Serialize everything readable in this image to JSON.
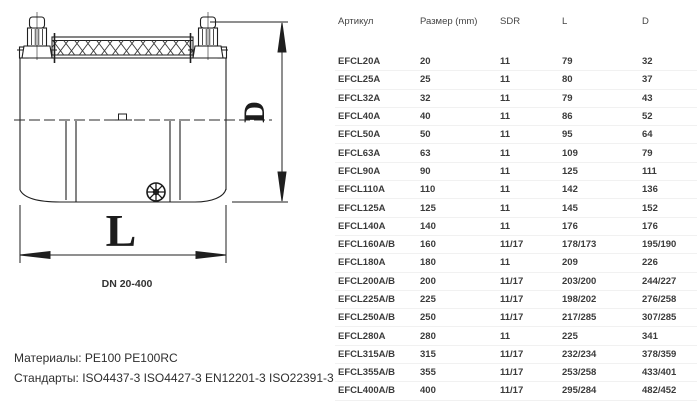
{
  "diagram": {
    "dimension_labels": {
      "diameter": "D",
      "length": "L"
    },
    "caption": "DN 20-400",
    "icons": {
      "center_symbol": "mold-date-wheel-icon"
    }
  },
  "notes": {
    "materials": "Материалы: PE100 PE100RC",
    "standards": "Стандарты: ISO4437-3 ISO4427-3 EN12201-3 ISO22391-3"
  },
  "table": {
    "headers": [
      "Артикул",
      "Размер (mm)",
      "SDR",
      "L",
      "D"
    ],
    "rows": [
      [
        "EFCL20A",
        "20",
        "11",
        "79",
        "32"
      ],
      [
        "EFCL25A",
        "25",
        "11",
        "80",
        "37"
      ],
      [
        "EFCL32A",
        "32",
        "11",
        "79",
        "43"
      ],
      [
        "EFCL40A",
        "40",
        "11",
        "86",
        "52"
      ],
      [
        "EFCL50A",
        "50",
        "11",
        "95",
        "64"
      ],
      [
        "EFCL63A",
        "63",
        "11",
        "109",
        "79"
      ],
      [
        "EFCL90A",
        "90",
        "11",
        "125",
        "111"
      ],
      [
        "EFCL110A",
        "110",
        "11",
        "142",
        "136"
      ],
      [
        "EFCL125A",
        "125",
        "11",
        "145",
        "152"
      ],
      [
        "EFCL140A",
        "140",
        "11",
        "176",
        "176"
      ],
      [
        "EFCL160A/B",
        "160",
        "11/17",
        "178/173",
        "195/190"
      ],
      [
        "EFCL180A",
        "180",
        "11",
        "209",
        "226"
      ],
      [
        "EFCL200A/B",
        "200",
        "11/17",
        "203/200",
        "244/227"
      ],
      [
        "EFCL225A/B",
        "225",
        "11/17",
        "198/202",
        "276/258"
      ],
      [
        "EFCL250A/B",
        "250",
        "11/17",
        "217/285",
        "307/285"
      ],
      [
        "EFCL280A",
        "280",
        "11",
        "225",
        "341"
      ],
      [
        "EFCL315A/B",
        "315",
        "11/17",
        "232/234",
        "378/359"
      ],
      [
        "EFCL355A/B",
        "355",
        "11/17",
        "253/258",
        "433/401"
      ],
      [
        "EFCL400A/B",
        "400",
        "11/17",
        "295/284",
        "482/452"
      ]
    ]
  },
  "colors": {
    "text": "#3b3b3b",
    "line": "#1f1f1f",
    "row_divider": "#f1f1f1",
    "background": "#ffffff"
  }
}
